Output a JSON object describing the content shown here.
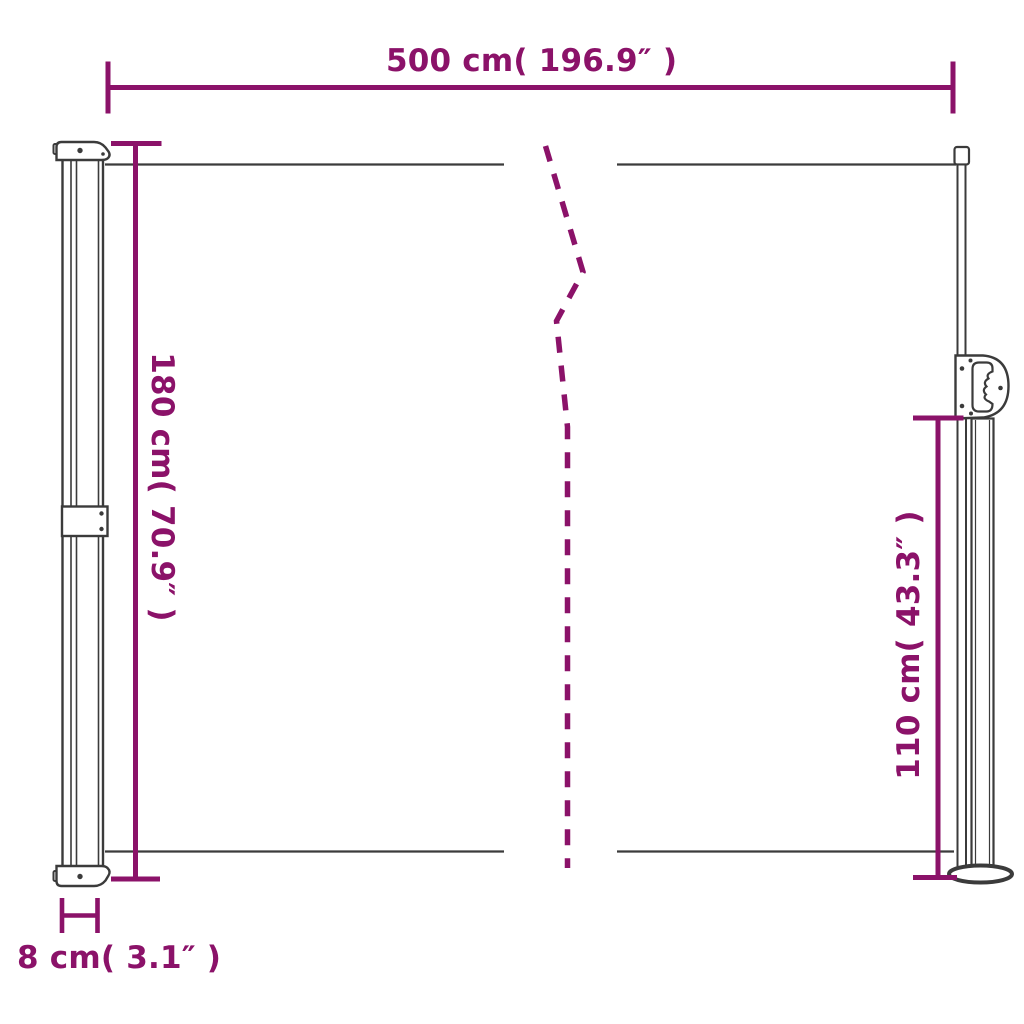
{
  "colors": {
    "dimension": "#8B1269",
    "ink": "#3b3b3b",
    "background": "#ffffff"
  },
  "diagram": {
    "type": "product-dimension-diagram",
    "subject": "retractable side awning with cassette, pull-out pole and floor base",
    "labels": {
      "width": "500 cm( 196.9″ )",
      "height": "180 cm( 70.9″ )",
      "pole_height": "110 cm( 43.3″ )",
      "depth": "8 cm( 3.1″ )"
    }
  }
}
